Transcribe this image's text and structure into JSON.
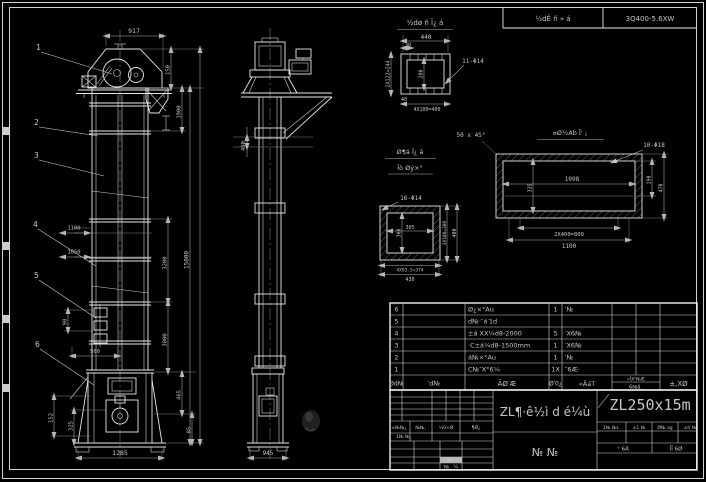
{
  "header_strip": {
    "project_cell": "½dÊ ñ » á",
    "drawing_no_cell": "3Q400-5.6XW"
  },
  "front_view": {
    "balloons": [
      "1",
      "2",
      "3",
      "4",
      "5",
      "6"
    ],
    "dims": {
      "top_width": "917",
      "head_1": "150",
      "head_2": "1900",
      "mid_1": "3200",
      "mid_2": "3000",
      "total_height": "15000",
      "left_1": "1100",
      "left_2": "1050",
      "bucket": "90",
      "feed": "500",
      "boot_left_1": "152",
      "boot_left_2": "325",
      "boot_right_1": "465",
      "boot_right_2": "85",
      "boot_width": "1285"
    }
  },
  "side_view": {
    "dims": {
      "section": "490",
      "base_width": "945"
    }
  },
  "detail_head_flange": {
    "title": "½dø ñ Ī¿ á",
    "hole_callout": "11-Φ14",
    "dims": {
      "width": "440",
      "offset": "30",
      "holes_v": "2X122=244",
      "inner": "280",
      "offset_b": "40",
      "holes_h": "4X100=400"
    }
  },
  "detail_square_flange": {
    "title_line1": "Ø¶á Ī¿ á",
    "title_line2": "Īò Øý×°",
    "hole_callout": "16-Φ14",
    "dims": {
      "inner_w": "305",
      "inner_h": "300",
      "holes_v": "3X100=300",
      "height": "400",
      "holes_h": "4X93.5=374",
      "width": "430"
    }
  },
  "detail_inlet_flange": {
    "title": "¤Ø½Ab Ī' ¡",
    "chamfer_note": "50 x 45°",
    "hole_callout": "10-Φ18",
    "dims": {
      "inner_w": "1098",
      "inner_h": "325",
      "right_1": "190",
      "right_2": "470",
      "holes_h": "2X400=800",
      "width": "1100"
    }
  },
  "bom": {
    "rows": [
      {
        "no": "6",
        "code": "",
        "name": "Ø¿×°Au",
        "qty": "1",
        "material": "′№"
      },
      {
        "no": "5",
        "code": "",
        "name": "d№·″á′1d",
        "qty": "",
        "material": ""
      },
      {
        "no": "4",
        "code": "",
        "name": "±á XX¼d8-2000",
        "qty": "5",
        "material": "′X6№"
      },
      {
        "no": "3",
        "code": "",
        "name": "·C±á¼d8-1500mm",
        "qty": "1",
        "material": "′X6№"
      },
      {
        "no": "2",
        "code": "",
        "name": "á№×°Au",
        "qty": "1",
        "material": "′№"
      },
      {
        "no": "1",
        "code": "",
        "name": "C№″X°6¼",
        "qty": "1X",
        "material": "″6Æ·"
      }
    ],
    "footer": {
      "no": "Ød№",
      "code": "′d№",
      "name": "ÃØ′Æ",
      "qty": "Ø′0¿",
      "material": "«ÃáT",
      "weight_top": "«ĪX¹№Æ",
      "weight_bottom": "6№á¸",
      "note": "±,XØ"
    }
  },
  "title_block": {
    "model": "ZL250x15m",
    "title": "ZL¶·ê½ì d é¼ù",
    "sheet_type": "№  №",
    "rev_labels": [
      "±№№¿",
      "№№¸",
      "¼0×Ø",
      "¶Ø¿"
    ],
    "rev_row2": "1№ №¸",
    "stamp": "№¸",
    "stamp_label": "№¸ ¼",
    "approval_header": [
      "1№ №L",
      "±1 №",
      "Ø№ ag",
      "±h №"
    ],
    "sheet_left": "° 6Á",
    "sheet_right": "ĪĪ 6Ø"
  },
  "colors": {
    "background": "#000000",
    "line": "#e8e8e8",
    "dim_text": "#c6c6c6"
  }
}
